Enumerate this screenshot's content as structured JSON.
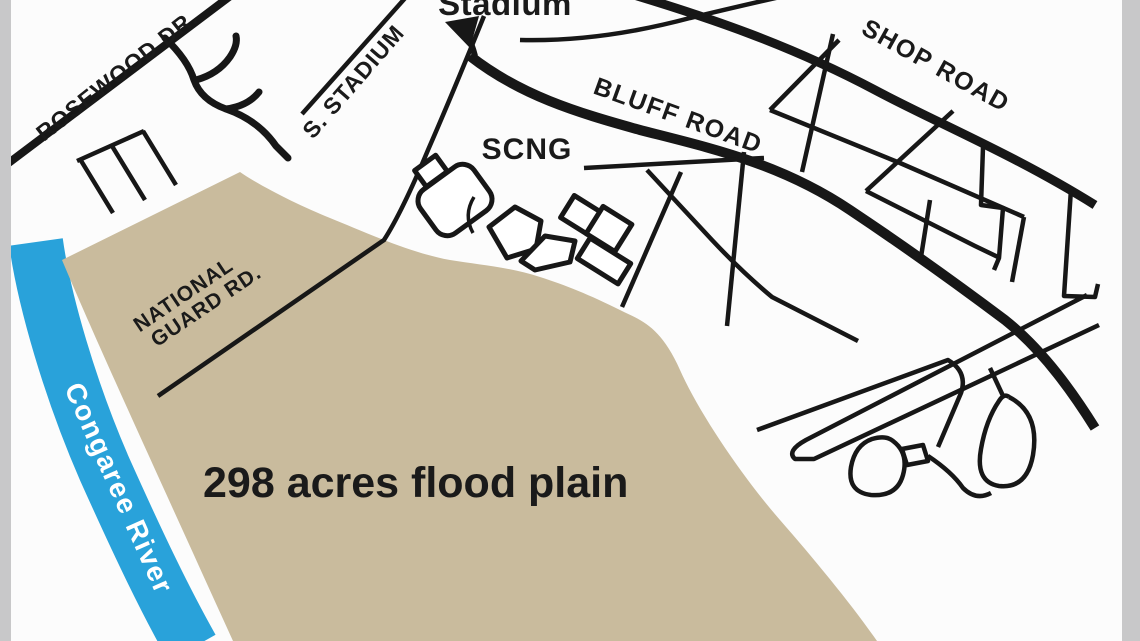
{
  "map": {
    "description": "Street locator map of flood plain near Congaree River",
    "labels": {
      "stadium": "Stadium",
      "rosewood_dr": "ROSEWOOD DR.",
      "s_stadium": "S. STADIUM",
      "bluff_road": "BLUFF ROAD",
      "shop_road": "SHOP ROAD",
      "scng": "SCNG",
      "national_guard_line1": "NATIONAL",
      "national_guard_line2": "GUARD RD.",
      "flood_plain": "298 acres flood plain",
      "river": "Congaree River"
    },
    "colors": {
      "background": "#fcfcfc",
      "flood_plain_fill": "#c9bb9d",
      "river_fill": "#29a2da",
      "road_color": "#171717",
      "label_color": "#1a1a1a",
      "river_label_color": "#ffffff",
      "edge_strip": "#c8c8c9"
    }
  }
}
